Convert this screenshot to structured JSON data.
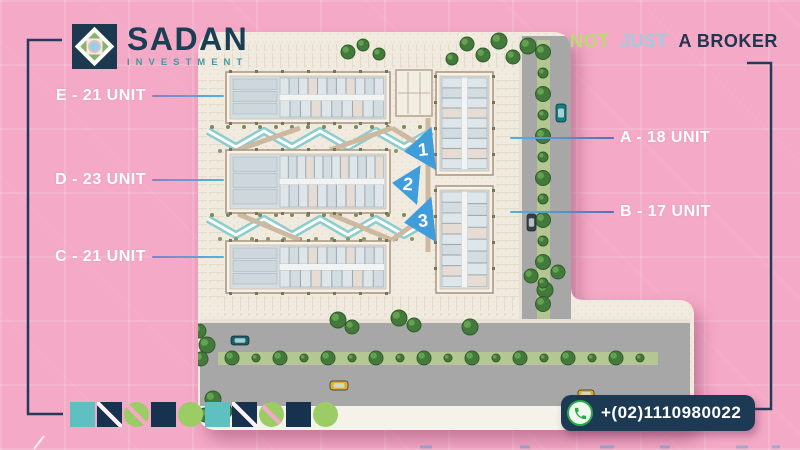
{
  "brand": {
    "name": "SADAN",
    "subtitle": "INVESTMENT"
  },
  "tagline": {
    "word1": "NOT",
    "word2": "JUST",
    "word3": "A BROKER"
  },
  "unit_labels": {
    "left": [
      {
        "building": "E",
        "text": "E - 21 UNIT"
      },
      {
        "building": "D",
        "text": "D - 23 UNIT"
      },
      {
        "building": "C",
        "text": "C - 21 UNIT"
      }
    ],
    "right": [
      {
        "building": "A",
        "text": "A - 18 UNIT"
      },
      {
        "building": "B",
        "text": "B - 17 UNIT"
      }
    ]
  },
  "buildings": [
    {
      "id": "E",
      "units": 21,
      "orientation": "horizontal"
    },
    {
      "id": "D",
      "units": 23,
      "orientation": "horizontal"
    },
    {
      "id": "C",
      "units": 21,
      "orientation": "horizontal"
    },
    {
      "id": "A",
      "units": 18,
      "orientation": "vertical"
    },
    {
      "id": "B",
      "units": 17,
      "orientation": "vertical"
    }
  ],
  "plan_markers": [
    "1",
    "2",
    "3"
  ],
  "contact": {
    "phone": "+(02)1110980022"
  },
  "colors": {
    "background_pink": "#f4a9c6",
    "navy": "#22385a",
    "teal": "#5fc0c2",
    "lime": "#a5cf6a",
    "light_blue": "#9fccdf",
    "marker_blue": "#3f9ddb",
    "label_line_blue": "#4fb3e6",
    "badge_navy": "#1d3a55",
    "phone_green": "#2aa84a"
  },
  "decor_chips": [
    {
      "shape": "square",
      "color": "teal",
      "stripe": "none"
    },
    {
      "shape": "square",
      "color": "navy",
      "stripe": "white"
    },
    {
      "shape": "circle",
      "color": "green",
      "stripe": "pink"
    },
    {
      "shape": "square",
      "color": "navy",
      "stripe": "none"
    },
    {
      "shape": "circle",
      "color": "green",
      "stripe": "none"
    },
    {
      "shape": "square",
      "color": "teal",
      "stripe": "none"
    },
    {
      "shape": "square",
      "color": "navy",
      "stripe": "white"
    },
    {
      "shape": "circle",
      "color": "green",
      "stripe": "pink"
    },
    {
      "shape": "square",
      "color": "navy",
      "stripe": "none"
    },
    {
      "shape": "circle",
      "color": "green",
      "stripe": "none"
    }
  ]
}
